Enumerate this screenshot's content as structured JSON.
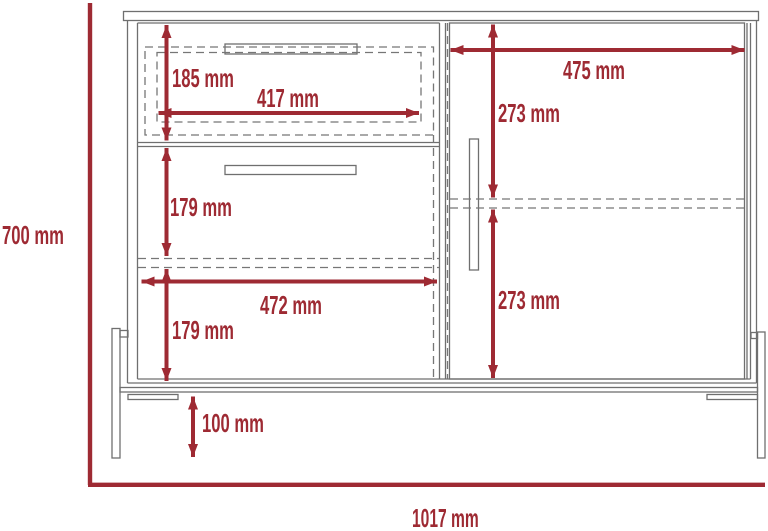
{
  "diagram": {
    "kind": "furniture dimension drawing (cabinet front elevation)",
    "units": "mm",
    "colors": {
      "dimension_accent": "#9e2a33",
      "line_art": "#6f6f6f",
      "background": "#ffffff"
    },
    "labels": {
      "overall_height": "700 mm",
      "overall_width": "1017 mm",
      "top_drawer_height": "185 mm",
      "top_drawer_width": "417 mm",
      "middle_drawer_height": "179 mm",
      "bottom_compartment_width": "472 mm",
      "bottom_compartment_height": "179 mm",
      "leg_height": "100 mm",
      "door_width": "475 mm",
      "door_upper_half_height": "273 mm",
      "door_lower_half_height": "273 mm"
    },
    "values_mm": {
      "overall_height": 700,
      "overall_width": 1017,
      "top_drawer_height": 185,
      "top_drawer_width": 417,
      "middle_drawer_height": 179,
      "bottom_compartment_width": 472,
      "bottom_compartment_height": 179,
      "leg_height": 100,
      "door_width": 475,
      "door_upper_half_height": 273,
      "door_lower_half_height": 273
    }
  }
}
